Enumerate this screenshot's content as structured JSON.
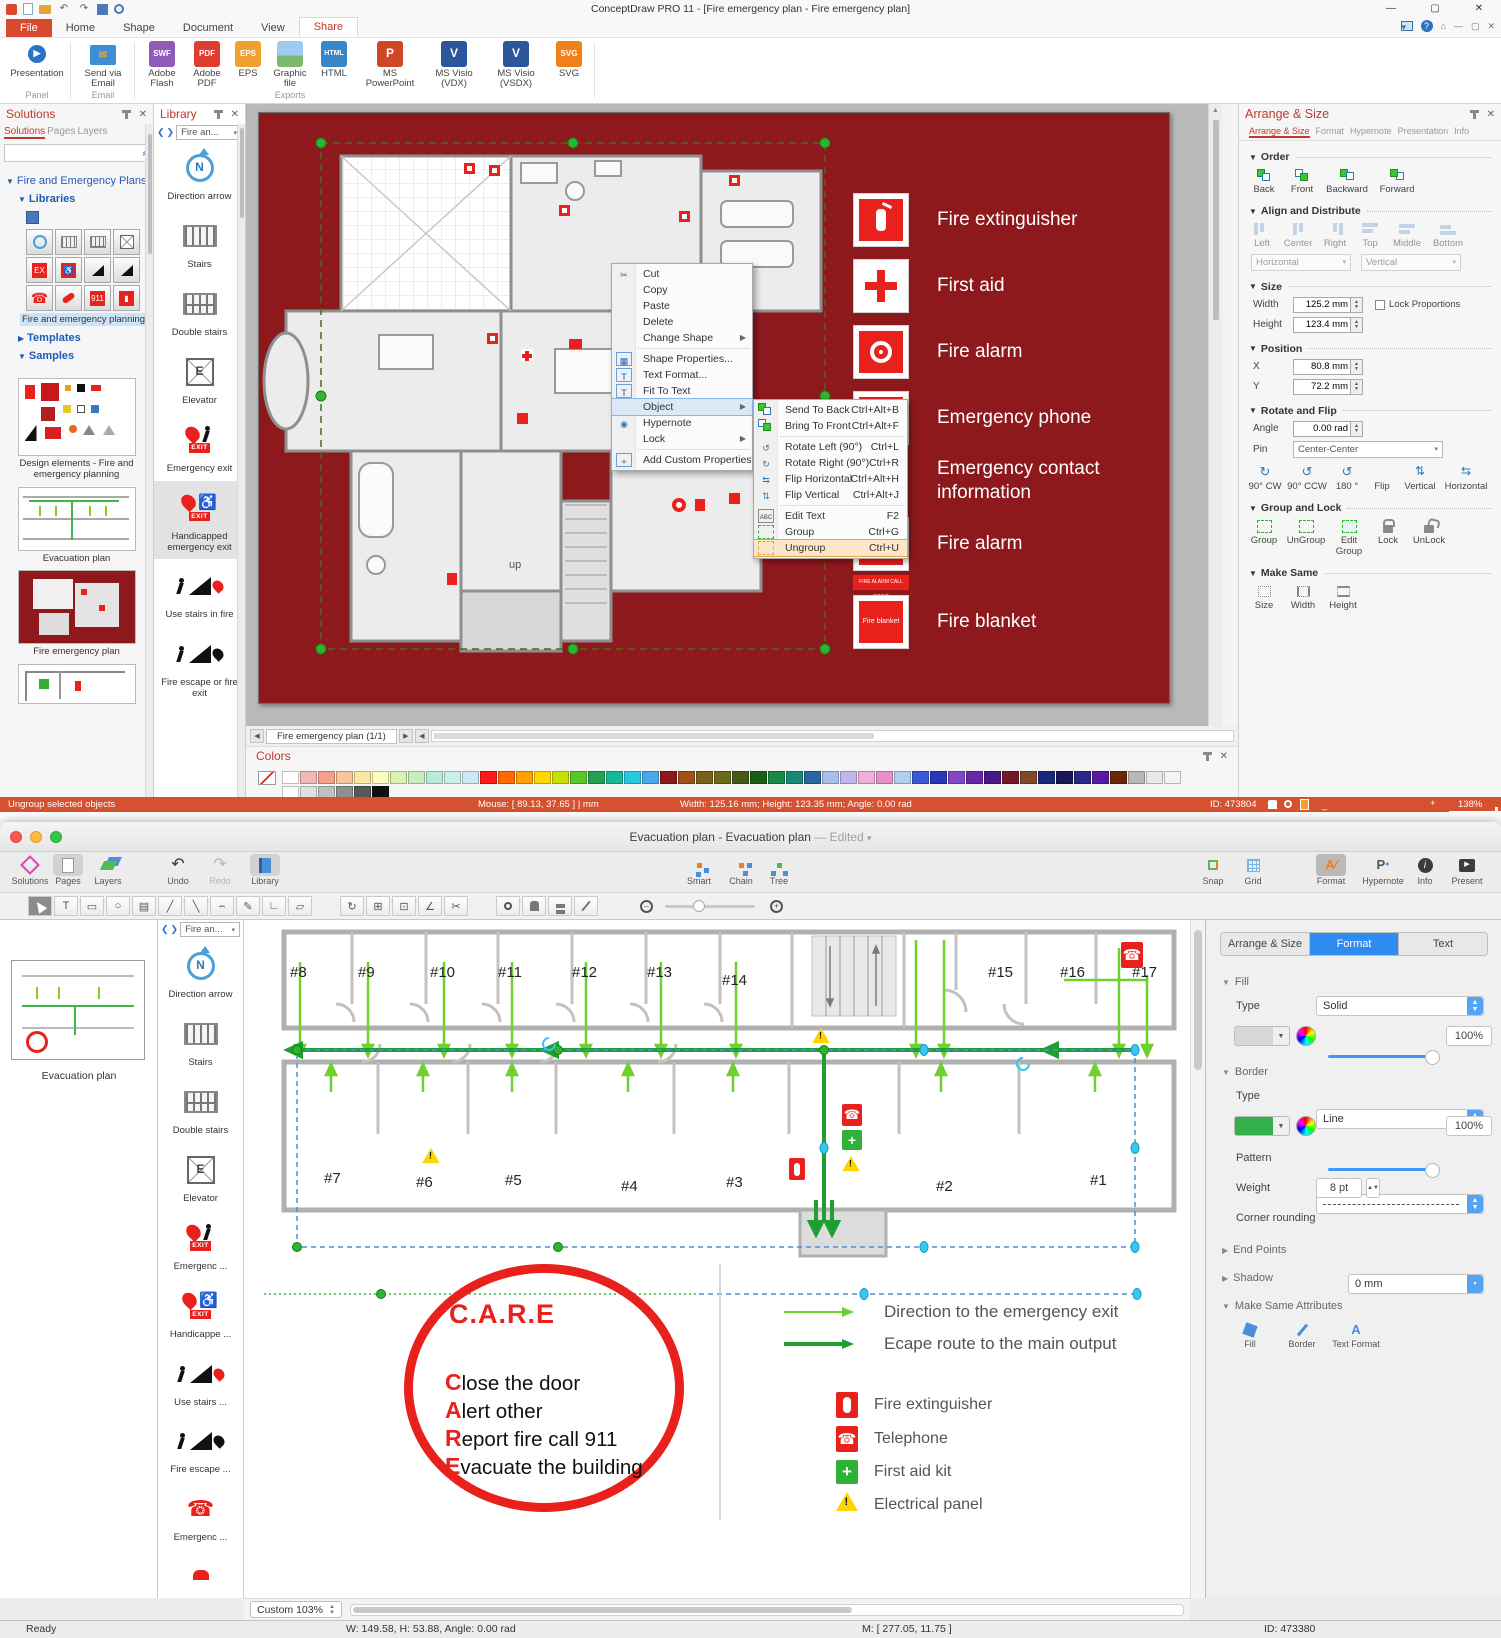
{
  "pc": {
    "title": "ConceptDraw PRO 11 - [Fire emergency plan - Fire emergency plan]",
    "tabs": [
      "File",
      "Home",
      "Shape",
      "Document",
      "View",
      "Share"
    ],
    "ribbon": {
      "presentation": "Presentation",
      "send_via_email": "Send via Email",
      "group_panel": "Panel",
      "group_email": "Email",
      "group_exports": "Exports",
      "exports": [
        {
          "label": "Adobe Flash",
          "badge": "SWF",
          "color": "#8e5bb8"
        },
        {
          "label": "Adobe PDF",
          "badge": "PDF",
          "color": "#e03c31"
        },
        {
          "label": "EPS",
          "badge": "EPS",
          "color": "#f0a030"
        },
        {
          "label": "Graphic file",
          "badge": "IMG",
          "color": "#7fb96e"
        },
        {
          "label": "HTML",
          "badge": "HTML",
          "color": "#3a87c8"
        },
        {
          "label": "MS PowerPoint",
          "badge": "P",
          "color": "#d04727"
        },
        {
          "label": "MS Visio (VDX)",
          "badge": "V",
          "color": "#2b579a"
        },
        {
          "label": "MS Visio (VSDX)",
          "badge": "V",
          "color": "#2b579a"
        },
        {
          "label": "SVG",
          "badge": "SVG",
          "color": "#f08019"
        }
      ]
    },
    "solutions": {
      "title": "Solutions",
      "tabs": [
        "Solutions",
        "Pages",
        "Layers"
      ],
      "root": "Fire and Emergency Plans",
      "libraries": "Libraries",
      "library_caption": "Fire and emergency planning",
      "templates": "Templates",
      "samples": "Samples",
      "sample_captions": [
        "Design elements - Fire and emergency planning",
        "Evacuation plan",
        "Fire emergency plan"
      ]
    },
    "library": {
      "title": "Library",
      "nav": "Fire an...",
      "items": [
        "Direction arrow",
        "Stairs",
        "Double stairs",
        "Elevator",
        "Emergency exit",
        "Handicapped emergency exit",
        "Use stairs in fire",
        "Fire escape or fire exit"
      ]
    },
    "icons": {
      "exit": "EXIT",
      "north": "N",
      "elevator": "E"
    },
    "canvas": {
      "legend": [
        "Fire extinguisher",
        "First aid",
        "Fire alarm",
        "Emergency phone",
        "Emergency contact information",
        "Fire alarm",
        "Fire blanket"
      ],
      "blanket_icon_text": "Fire blanket",
      "call_point_sign": "FIRE ALARM CALL POINT",
      "up_label": "up"
    },
    "context_menu": {
      "items": [
        {
          "label": "Cut"
        },
        {
          "label": "Copy"
        },
        {
          "label": "Paste"
        },
        {
          "label": "Delete"
        },
        {
          "label": "Change Shape"
        },
        {
          "label": "Shape Properties..."
        },
        {
          "label": "Text Format..."
        },
        {
          "label": "Fit To Text"
        },
        {
          "label": "Object"
        },
        {
          "label": "Hypernote"
        },
        {
          "label": "Lock"
        },
        {
          "label": "Add Custom Properties"
        }
      ]
    },
    "object_submenu": {
      "items": [
        {
          "label": "Send To Back",
          "shortcut": "Ctrl+Alt+B"
        },
        {
          "label": "Bring To Front",
          "shortcut": "Ctrl+Alt+F"
        },
        {
          "label": "Rotate Left (90°)",
          "shortcut": "Ctrl+L"
        },
        {
          "label": "Rotate Right (90°)",
          "shortcut": "Ctrl+R"
        },
        {
          "label": "Flip Horizontal",
          "shortcut": "Ctrl+Alt+H"
        },
        {
          "label": "Flip Vertical",
          "shortcut": "Ctrl+Alt+J"
        },
        {
          "label": "Edit Text",
          "shortcut": "F2"
        },
        {
          "label": "Group",
          "shortcut": "Ctrl+G"
        },
        {
          "label": "Ungroup",
          "shortcut": "Ctrl+U"
        }
      ]
    },
    "arrange": {
      "title": "Arrange & Size",
      "tabs": [
        "Arrange & Size",
        "Format",
        "Hypernote",
        "Presentation",
        "Info"
      ],
      "order_label": "Order",
      "order_buttons": [
        "Back",
        "Front",
        "Backward",
        "Forward"
      ],
      "align_label": "Align and Distribute",
      "align_buttons": [
        "Left",
        "Center",
        "Right",
        "Top",
        "Middle",
        "Bottom"
      ],
      "align_h": "Horizontal",
      "align_v": "Vertical",
      "size_label": "Size",
      "width_label": "Width",
      "width_value": "125.2 mm",
      "height_label": "Height",
      "height_value": "123.4 mm",
      "lock_label": "Lock Proportions",
      "position_label": "Position",
      "x_label": "X",
      "x_value": "80.8 mm",
      "y_label": "Y",
      "y_value": "72.2 mm",
      "rotate_label": "Rotate and Flip",
      "angle_label": "Angle",
      "angle_value": "0.00 rad",
      "pin_label": "Pin",
      "pin_value": "Center-Center",
      "rotate_buttons": [
        "90° CW",
        "90° CCW",
        "180 °",
        "Flip",
        "Vertical",
        "Horizontal"
      ],
      "group_label": "Group and Lock",
      "group_buttons": [
        "Group",
        "UnGroup",
        "Edit Group",
        "Lock",
        "UnLock"
      ],
      "same_label": "Make Same",
      "same_buttons": [
        "Size",
        "Width",
        "Height"
      ]
    },
    "page_tab": "Fire emergency plan (1/1)",
    "colors": {
      "title": "Colors",
      "palette": [
        "#ffffff",
        "#f2b8b8",
        "#f4a08c",
        "#f7c59a",
        "#f9e8a0",
        "#fdfdc0",
        "#d9f2b0",
        "#c8eec0",
        "#b8ecd8",
        "#c8f0ea",
        "#cfe8f5",
        "#ff1a1a",
        "#ff6a00",
        "#ffa000",
        "#ffd800",
        "#c8e000",
        "#58c828",
        "#22a050",
        "#18b89a",
        "#28c8e0",
        "#48a8e8",
        "#8c1818",
        "#a05018",
        "#786018",
        "#6a6a18",
        "#485818",
        "#186018",
        "#188848",
        "#188878",
        "#2868a0",
        "#a8c0e8",
        "#c0b8ec",
        "#f0b0d8",
        "#e890c8",
        "#b0d0f0",
        "#3858d8",
        "#2838b8",
        "#8048c8",
        "#6828a8",
        "#481888",
        "#701828",
        "#804828",
        "#182878",
        "#181858",
        "#282888",
        "#5818a0",
        "#682808",
        "#b8b8b8",
        "#e8e8e8",
        "#f4f4f4"
      ],
      "palette2": [
        "#ffffff",
        "#e0e0e0",
        "#c0c0c0",
        "#909090",
        "#585858",
        "#101010"
      ]
    },
    "status": {
      "message": "Ungroup selected objects",
      "mouse": "Mouse: [ 89.13, 37.65 ] | mm",
      "metrics": "Width: 125.16 mm;  Height: 123.35 mm;  Angle: 0.00 rad",
      "object_id": "ID: 473804",
      "zoom": "138%"
    }
  },
  "mac": {
    "title": "Evacuation plan - Evacuation plan",
    "title_suffix": "— Edited",
    "toolbar": {
      "solutions": "Solutions",
      "pages": "Pages",
      "layers": "Layers",
      "undo": "Undo",
      "redo": "Redo",
      "library": "Library",
      "smart": "Smart",
      "chain": "Chain",
      "tree": "Tree",
      "snap": "Snap",
      "grid": "Grid",
      "format": "Format",
      "hypernote": "Hypernote",
      "info": "Info",
      "present": "Present"
    },
    "sidebar": {
      "thumbnail_caption": "Evacuation plan"
    },
    "library": {
      "nav": "Fire an...",
      "items": [
        "Direction arrow",
        "Stairs",
        "Double stairs",
        "Elevator",
        "Emergenc ...",
        "Handicappe ...",
        "Use stairs ...",
        "Fire escape ...",
        "Emergenc ..."
      ]
    },
    "rooms_top": [
      "#8",
      "#9",
      "#10",
      "#11",
      "#12",
      "#13",
      "#14",
      "#15",
      "#16",
      "#17"
    ],
    "rooms_bottom": [
      "#7",
      "#6",
      "#5",
      "#4",
      "#3",
      "#2",
      "#1"
    ],
    "care": {
      "title": "C.A.R.E",
      "line1_initial": "C",
      "line1_rest": "lose the door",
      "line2_initial": "A",
      "line2_rest": "lert other",
      "line3_initial": "R",
      "line3_rest": "eport fire call 911",
      "line4_initial": "E",
      "line4_rest": "vacuate the building"
    },
    "legend": {
      "direction": "Direction to the emergency exit",
      "escape": "Ecape route to the main output",
      "extinguisher": "Fire extinguisher",
      "telephone": "Telephone",
      "first_aid": "First aid kit",
      "electrical": "Electrical panel"
    },
    "format_panel": {
      "tabs": [
        "Arrange & Size",
        "Format",
        "Text"
      ],
      "fill_label": "Fill",
      "fill_type_label": "Type",
      "fill_type": "Solid",
      "fill_opacity": "100%",
      "border_label": "Border",
      "border_type_label": "Type",
      "border_type": "Line",
      "border_opacity": "100%",
      "pattern_label": "Pattern",
      "weight_label": "Weight",
      "weight": "8 pt",
      "corner_label": "Corner rounding",
      "corner": "0 mm",
      "endpoints_label": "End Points",
      "shadow_label": "Shadow",
      "same_label": "Make Same Attributes",
      "same_items": [
        "Fill",
        "Border",
        "Text Format"
      ],
      "accent": "#2e8bf0",
      "border_color": "#33b04a"
    },
    "zoom_control": "Custom 103%",
    "status": {
      "ready": "Ready",
      "metrics": "W: 149.58,  H: 53.88,  Angle: 0.00 rad",
      "mouse": "M: [ 277.05, 11.75 ]",
      "object_id": "ID: 473380"
    }
  }
}
